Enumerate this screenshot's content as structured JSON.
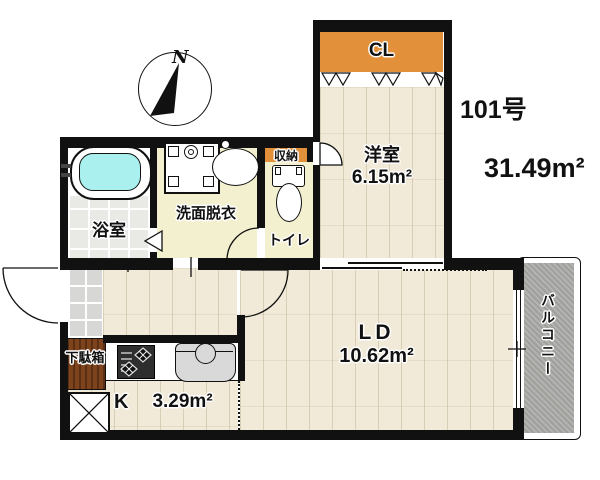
{
  "unit": {
    "room_number": "101号",
    "total_area": "31.49m²"
  },
  "compass": {
    "north_label": "N"
  },
  "rooms": {
    "closet": {
      "label": "CL"
    },
    "western_room": {
      "label": "洋室",
      "area": "6.15m²"
    },
    "living_dining": {
      "label": "LD",
      "area": "10.62m²"
    },
    "kitchen": {
      "label": "K",
      "area": "3.29m²"
    },
    "bathroom": {
      "label": "浴室"
    },
    "washroom": {
      "label": "洗面脱衣"
    },
    "toilet": {
      "label": "トイレ"
    },
    "storage": {
      "label": "収納"
    },
    "shoe_cabinet": {
      "label": "下駄箱"
    },
    "balcony": {
      "label": "バルコニー"
    }
  },
  "colors": {
    "wall": "#111111",
    "closet_orange": "#e2913a",
    "shoe_cabinet_brown": "#7d431d",
    "balcony_gray": "#a9a9a6",
    "bathtub_cyan": "#a9f0ee",
    "wood_floor": "#f1ead9",
    "service_floor": "#f3f0cf",
    "bath_tile": "#e9e9e6",
    "entry_tile": "#d7d7d5"
  }
}
